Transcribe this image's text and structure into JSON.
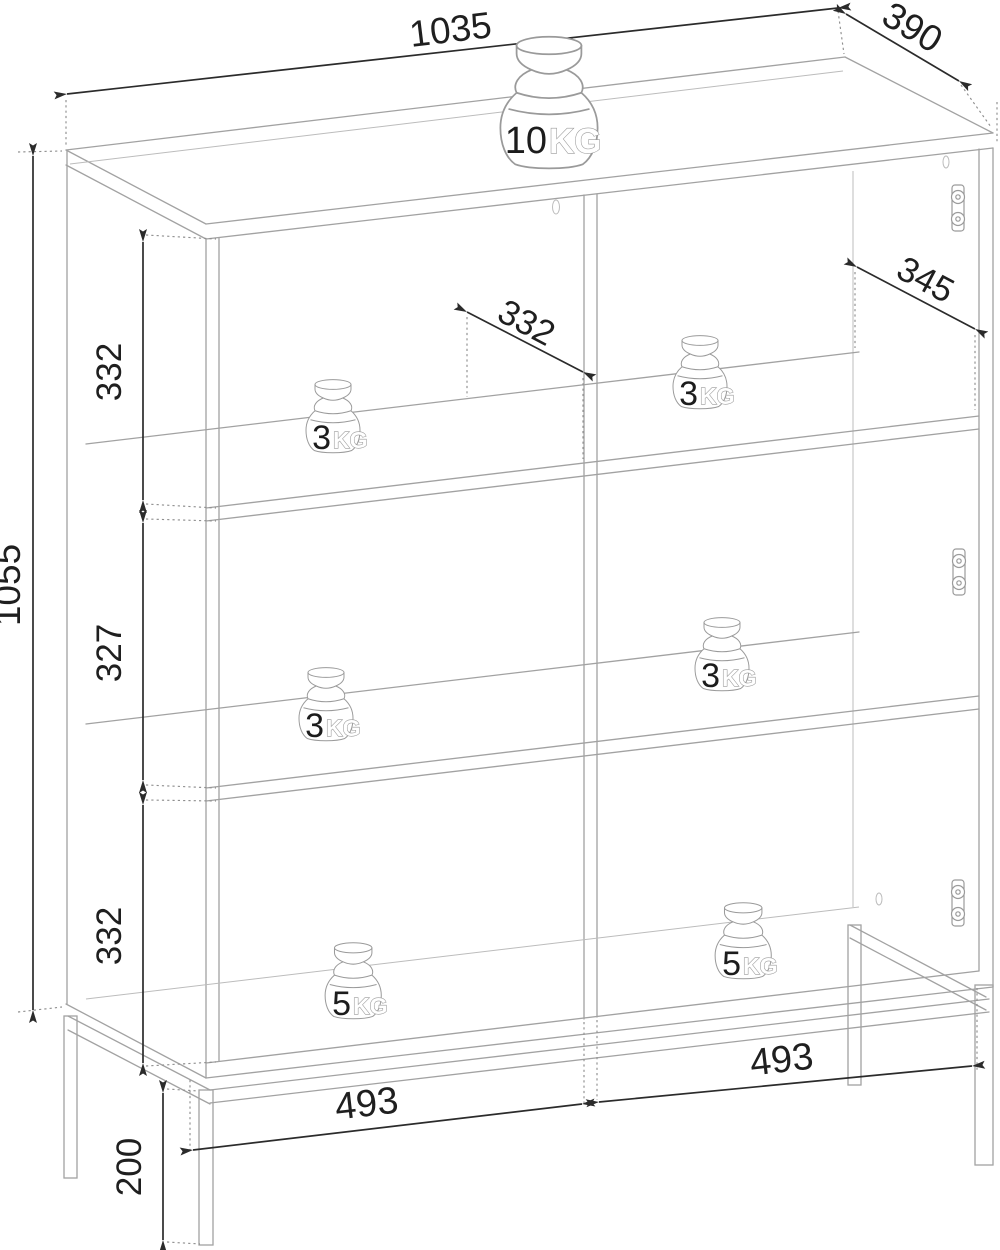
{
  "drawing": {
    "type": "furniture-dimension-diagram",
    "dims": {
      "overall_width": "1035",
      "overall_depth": "390",
      "body_height": "1055",
      "leg_height": "200",
      "section_top": "332",
      "section_middle": "327",
      "section_bottom": "332",
      "inner_depth_left": "332",
      "inner_depth_right": "345",
      "inner_width_left": "493",
      "inner_width_right": "493"
    },
    "weights": {
      "top": {
        "value": "10",
        "unit": "KG"
      },
      "left_shelf1": {
        "value": "3",
        "unit": "KG"
      },
      "right_shelf1": {
        "value": "3",
        "unit": "KG"
      },
      "left_shelf2": {
        "value": "3",
        "unit": "KG"
      },
      "right_shelf2": {
        "value": "3",
        "unit": "KG"
      },
      "left_bottom": {
        "value": "5",
        "unit": "KG"
      },
      "right_bottom": {
        "value": "5",
        "unit": "KG"
      }
    }
  }
}
